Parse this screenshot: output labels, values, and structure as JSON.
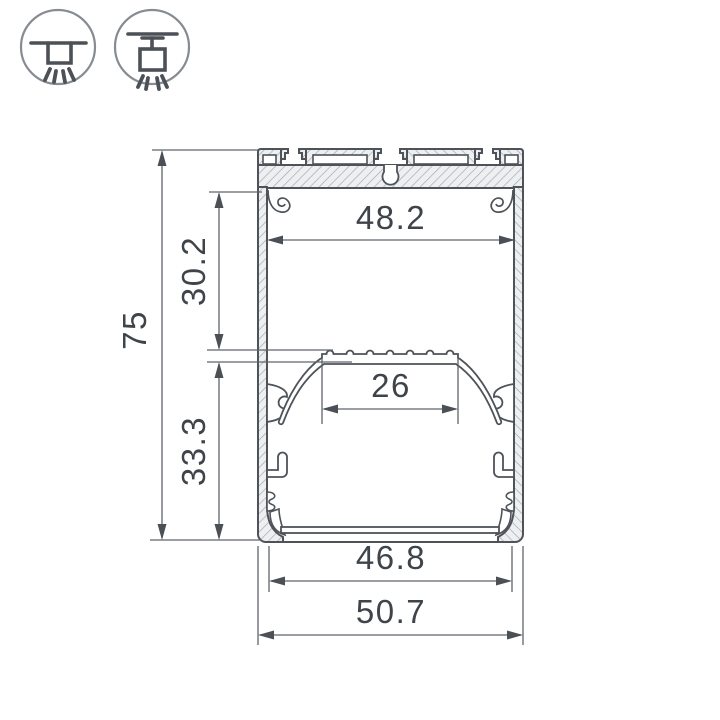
{
  "drawing": {
    "title": "led-profile-cross-section",
    "dimensions": {
      "overall_height": "75",
      "upper_cavity_height": "30.2",
      "lower_cavity_height": "33.3",
      "inner_width": "48.2",
      "led_platform_width": "26",
      "bottom_inner_width": "46.8",
      "overall_width": "50.7"
    },
    "colors": {
      "background": "#ffffff",
      "outline": "#4d5359",
      "dimension_line": "#5f656b",
      "arrow": "#4a5056",
      "text": "#3f444a",
      "hatch_fill": "#edeff1",
      "hatch_line": "#a0a7ad",
      "icon_circle": "#868c92",
      "icon_glyph": "#4c5157"
    }
  },
  "icons": {
    "surface_mount": "surface-mount-icon",
    "pendant_mount": "pendant-mount-icon"
  }
}
